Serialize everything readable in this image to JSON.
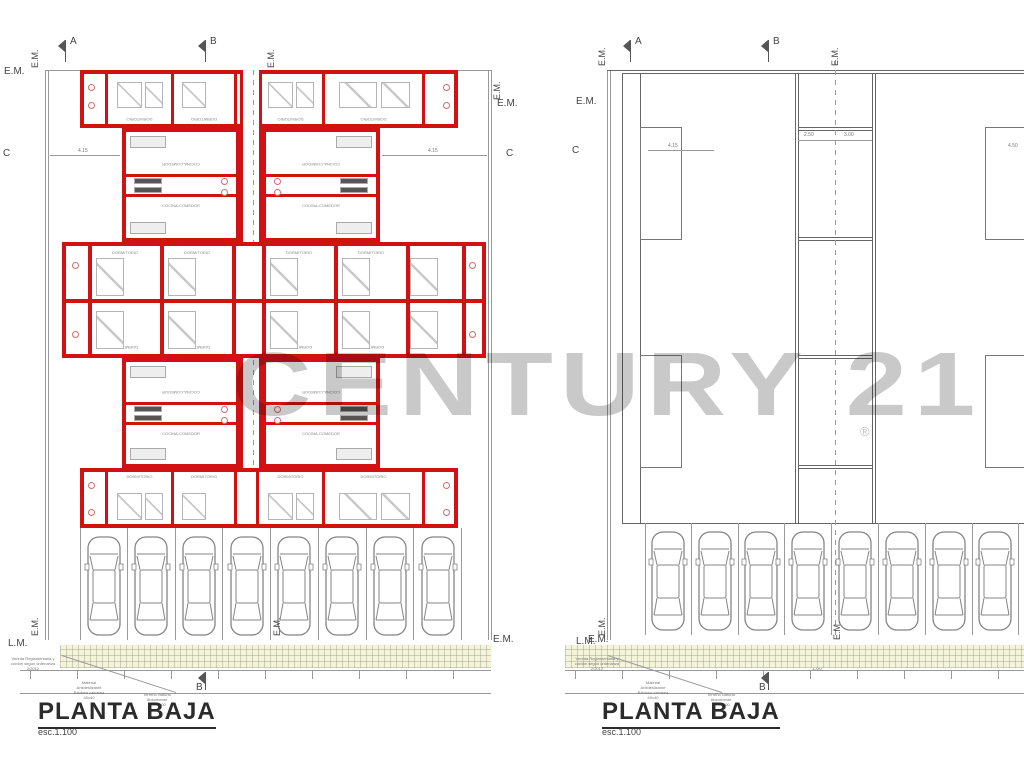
{
  "watermark": {
    "text": "CENTURY 21",
    "registered": "®",
    "color": "#c9c9c9"
  },
  "plans": {
    "left": {
      "title": "PLANTA BAJA",
      "scale": "esc.1.100"
    },
    "right": {
      "title": "PLANTA BAJA",
      "scale": "esc.1.100"
    }
  },
  "labels": {
    "dormitorio": "DORMITORIO",
    "cocina": "COCINA-COMEDOR",
    "bano": "BAÑO",
    "paso": "PASO"
  },
  "markers": {
    "a": "A",
    "b": "B",
    "c": "C",
    "em": "E.M.",
    "lm": "L.M."
  },
  "dimensions": {
    "d415": "4.15",
    "d250": "2.50",
    "d300": "3.00",
    "d450": "4.50",
    "d100": "1.00"
  },
  "annotations": {
    "vereda": "Vereda Reglamentaria y\ncordón según ordenanza\n2/2012",
    "material": "Material\nAntideslizante\nBaldosa calcárea\n40x40",
    "terreno": "Terreno Natural\nAbsorbente\n1.00x1.00"
  },
  "parking": {
    "left_count": 8,
    "right_count": 8
  },
  "colors": {
    "wall_red": "#d21212",
    "line_gray": "#9a9a9a",
    "sidewalk": "#f4f4db"
  }
}
